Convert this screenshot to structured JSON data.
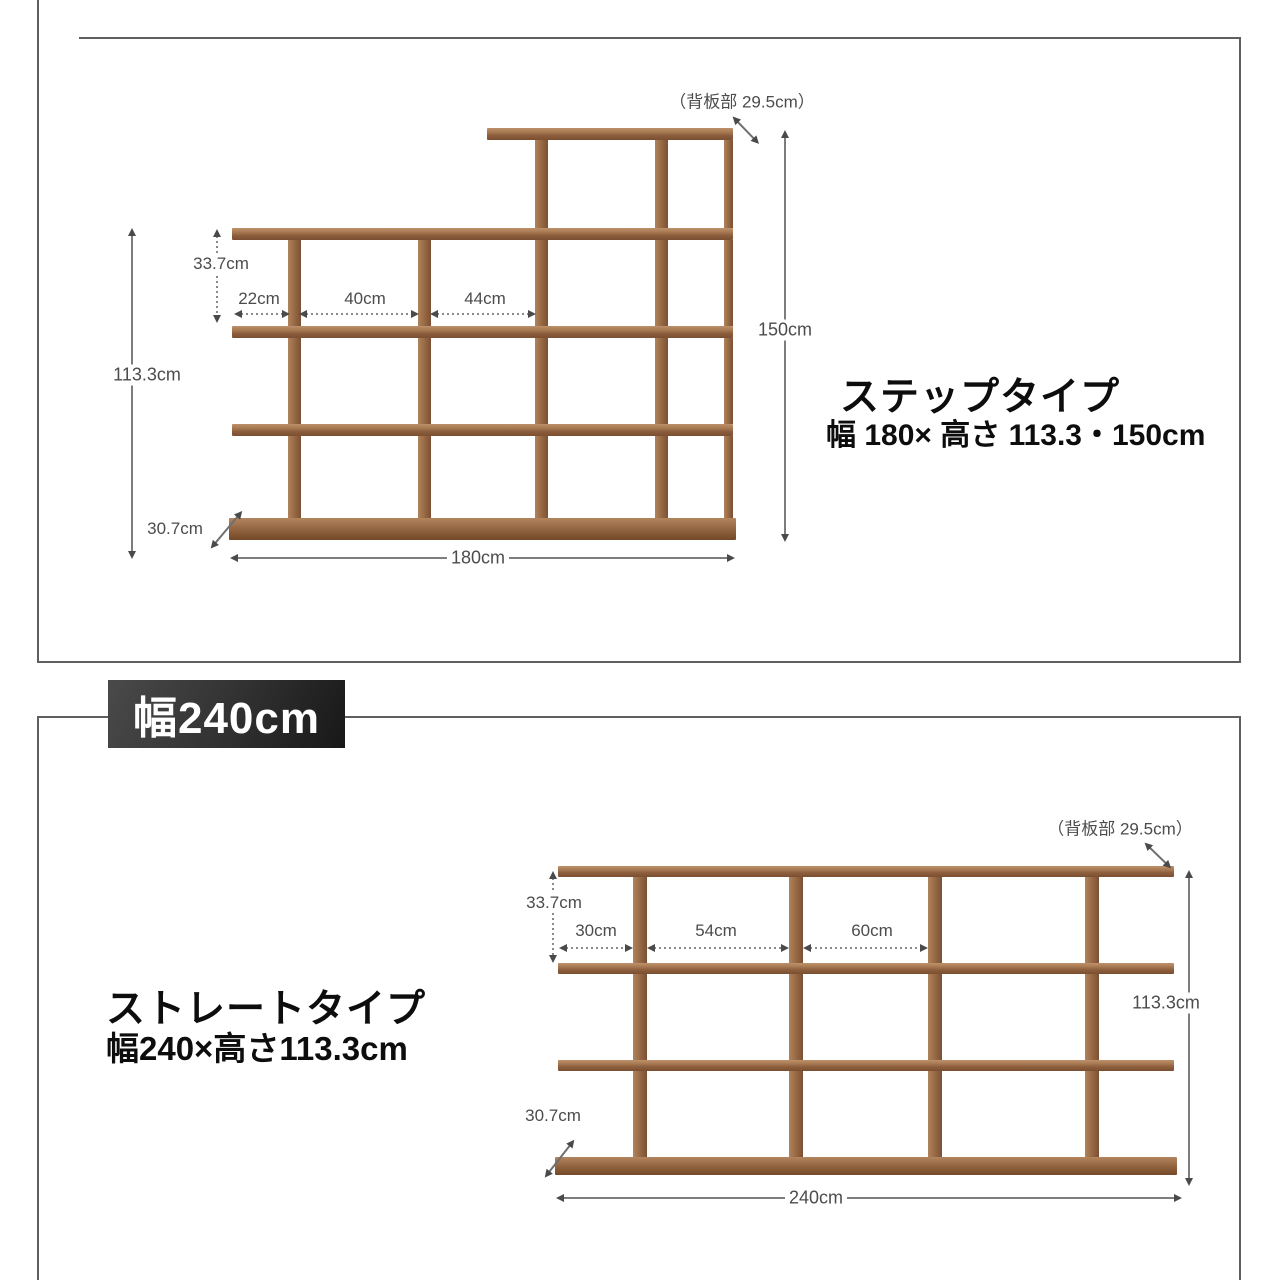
{
  "colors": {
    "wood_light": "#bd916b",
    "wood_mid": "#976945",
    "wood_dark": "#7a4e31",
    "dimension_line": "#7d7d7d",
    "panel_border": "#5f5f5f",
    "banner_bg": "#2e2e2e",
    "banner_text": "#ffffff"
  },
  "step_section": {
    "back_panel_note": "（背板部 29.5cm）",
    "height_total": "150cm",
    "height_body": "113.3cm",
    "shelf_inner_height": "33.7cm",
    "cubby_widths": [
      "22cm",
      "40cm",
      "44cm"
    ],
    "depth": "30.7cm",
    "width_total": "180cm",
    "title": "ステップタイプ",
    "subtitle": "幅 180× 高さ 113.3・150cm"
  },
  "width_banner": {
    "label": "幅240cm"
  },
  "straight_section": {
    "back_panel_note": "（背板部 29.5cm）",
    "height_body": "113.3cm",
    "shelf_inner_height": "33.7cm",
    "cubby_widths": [
      "30cm",
      "54cm",
      "60cm"
    ],
    "depth": "30.7cm",
    "width_total": "240cm",
    "title": "ストレートタイプ",
    "subtitle": "幅240×高さ113.3cm"
  }
}
